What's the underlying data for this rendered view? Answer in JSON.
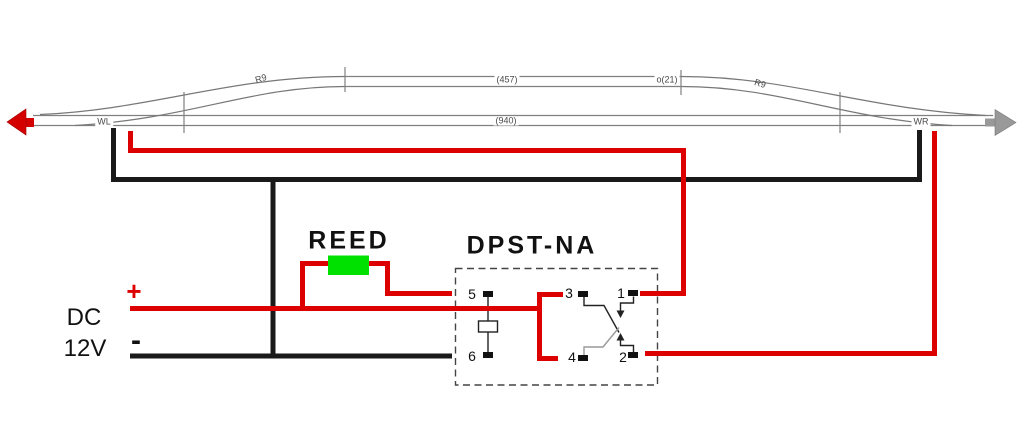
{
  "track": {
    "turnout_left": "WL",
    "turnout_right": "WR",
    "curve_left": "R9",
    "curve_right": "R9",
    "siding_length": "(457)",
    "filler_length": "o(21)",
    "main_length": "(940)"
  },
  "power_supply": {
    "name_line1": "DC",
    "name_line2": "12V",
    "positive_label": "+",
    "negative_label": "-"
  },
  "reed_switch": {
    "label": "REED"
  },
  "relay": {
    "label": "DPST-NA",
    "pins": {
      "p1": "1",
      "p2": "2",
      "p3": "3",
      "p4": "4",
      "p5": "5",
      "p6": "6"
    }
  },
  "colors": {
    "positive_wire": "#dd0000",
    "negative_wire": "#1a1a1a",
    "reed_body": "#00e100",
    "track_rail": "#808080",
    "arrow_left": "#d40000",
    "arrow_right": "#999999"
  }
}
